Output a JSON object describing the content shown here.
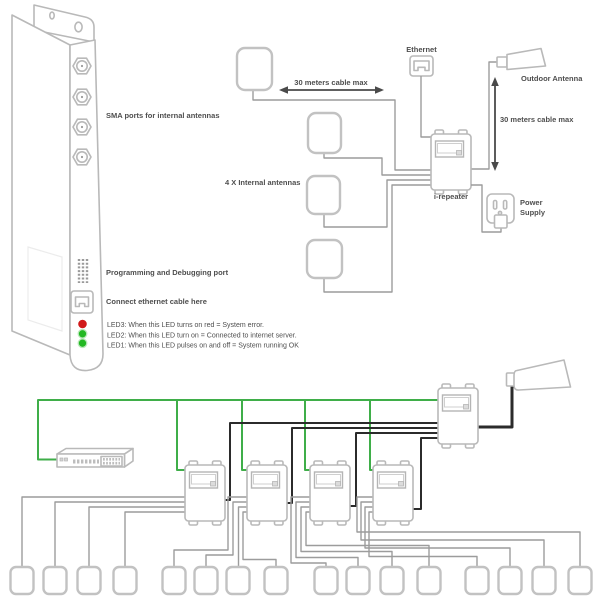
{
  "colors": {
    "cable_green": "#3fae49",
    "cable_black": "#2b2b2b",
    "outline": "#b9b9b9",
    "line": "#9c9c9c",
    "led_red": "#d11a1a",
    "led_green": "#23b823",
    "text": "#4e4e4e"
  },
  "top": {
    "labels": {
      "sma": "SMA ports for internal antennas",
      "programming": "Programming and Debugging port",
      "ethernet_here": "Connect ethernet cable here",
      "led3": "LED3: When this LED turns on red = System error.",
      "led2": "LED2: When this LED turn on = Connected to internet server.",
      "led1": "LED1: When this LED pulses on and off = System running OK",
      "antennas": "4 X  Internal antennas",
      "cable_h": "30 meters cable max",
      "cable_v": "30 meters cable max",
      "ethernet": "Ethernet",
      "outdoor": "Outdoor Antenna",
      "repeater": "i-repeater",
      "power1": "Power",
      "power2": "Supply"
    }
  },
  "icons": [
    "sma-port-icon",
    "pin-header-icon",
    "rj45-jack-icon",
    "led-indicator-icon",
    "patch-antenna-icon",
    "rj45-plug-icon",
    "yagi-antenna-icon",
    "repeater-box-icon",
    "wall-outlet-icon",
    "power-plug-icon",
    "rack-switch-icon",
    "ceiling-antenna-icon"
  ]
}
